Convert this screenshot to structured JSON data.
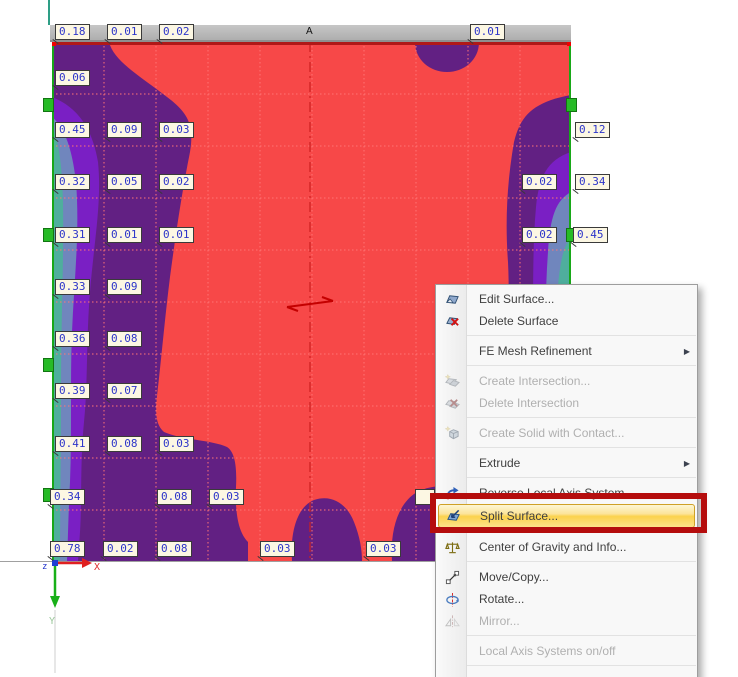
{
  "plot": {
    "section_label": "A",
    "axis": {
      "x": "X",
      "y": "Y",
      "z": "z"
    },
    "palette": {
      "field_red": "#f74848",
      "band_dark_purple": "#622083",
      "band_violet": "#7a1fc4",
      "band_slate_blue": "#7086bd",
      "band_teal": "#4fae9d",
      "grid_line": "#ff7575",
      "edge_line_green": "#18a818",
      "edge_line_red": "#b01818",
      "support_green": "#27bb27"
    },
    "value_labels": [
      {
        "v": "0.18",
        "x": 55,
        "y": 24
      },
      {
        "v": "0.01",
        "x": 107,
        "y": 24
      },
      {
        "v": "0.02",
        "x": 159,
        "y": 24
      },
      {
        "v": "0.01",
        "x": 470,
        "y": 24
      },
      {
        "v": "0.06",
        "x": 55,
        "y": 70
      },
      {
        "v": "0.45",
        "x": 55,
        "y": 122
      },
      {
        "v": "0.09",
        "x": 107,
        "y": 122
      },
      {
        "v": "0.03",
        "x": 159,
        "y": 122
      },
      {
        "v": "0.12",
        "x": 575,
        "y": 122
      },
      {
        "v": "0.32",
        "x": 55,
        "y": 174
      },
      {
        "v": "0.05",
        "x": 107,
        "y": 174
      },
      {
        "v": "0.02",
        "x": 159,
        "y": 174
      },
      {
        "v": "0.02",
        "x": 522,
        "y": 174
      },
      {
        "v": "0.34",
        "x": 575,
        "y": 174
      },
      {
        "v": "0.31",
        "x": 55,
        "y": 227
      },
      {
        "v": "0.01",
        "x": 107,
        "y": 227
      },
      {
        "v": "0.01",
        "x": 159,
        "y": 227
      },
      {
        "v": "0.02",
        "x": 522,
        "y": 227
      },
      {
        "v": "0.45",
        "x": 573,
        "y": 227
      },
      {
        "v": "0.33",
        "x": 55,
        "y": 279
      },
      {
        "v": "0.09",
        "x": 107,
        "y": 279
      },
      {
        "v": "0.36",
        "x": 55,
        "y": 331
      },
      {
        "v": "0.08",
        "x": 107,
        "y": 331
      },
      {
        "v": "0.39",
        "x": 55,
        "y": 383
      },
      {
        "v": "0.07",
        "x": 107,
        "y": 383
      },
      {
        "v": "0.41",
        "x": 55,
        "y": 436
      },
      {
        "v": "0.08",
        "x": 107,
        "y": 436
      },
      {
        "v": "0.03",
        "x": 159,
        "y": 436
      },
      {
        "v": "0.34",
        "x": 50,
        "y": 489
      },
      {
        "v": "0.08",
        "x": 157,
        "y": 489
      },
      {
        "v": "0.03",
        "x": 209,
        "y": 489
      },
      {
        "v": "",
        "x": 415,
        "y": 489,
        "partial": true
      },
      {
        "v": "0.78",
        "x": 50,
        "y": 541
      },
      {
        "v": "0.02",
        "x": 103,
        "y": 541
      },
      {
        "v": "0.08",
        "x": 157,
        "y": 541
      },
      {
        "v": "0.03",
        "x": 260,
        "y": 541
      },
      {
        "v": "0.03",
        "x": 366,
        "y": 541
      }
    ],
    "supports": [
      {
        "x": 43,
        "y": 98
      },
      {
        "x": 43,
        "y": 228
      },
      {
        "x": 43,
        "y": 358
      },
      {
        "x": 43,
        "y": 488
      },
      {
        "x": 566,
        "y": 98
      },
      {
        "x": 566,
        "y": 228
      }
    ]
  },
  "annotation": {
    "highlight_color": "#b50d0d"
  },
  "context_menu": {
    "items": [
      {
        "type": "item",
        "label": "Edit Surface...",
        "icon": "edit-surface-icon",
        "enabled": true
      },
      {
        "type": "item",
        "label": "Delete Surface",
        "icon": "delete-surface-icon",
        "enabled": true
      },
      {
        "type": "separator"
      },
      {
        "type": "item",
        "label": "FE Mesh Refinement",
        "enabled": true,
        "submenu": true
      },
      {
        "type": "separator"
      },
      {
        "type": "item",
        "label": "Create Intersection...",
        "icon": "create-intersection-icon",
        "enabled": false
      },
      {
        "type": "item",
        "label": "Delete Intersection",
        "icon": "delete-intersection-icon",
        "enabled": false
      },
      {
        "type": "separator"
      },
      {
        "type": "item",
        "label": "Create Solid with Contact...",
        "icon": "create-solid-icon",
        "enabled": false
      },
      {
        "type": "separator"
      },
      {
        "type": "item",
        "label": "Extrude",
        "enabled": true,
        "submenu": true
      },
      {
        "type": "separator"
      },
      {
        "type": "item",
        "label": "Reverse Local Axis System",
        "icon": "reverse-local-axis-icon",
        "enabled": true
      },
      {
        "type": "item",
        "label": "Split Surface...",
        "icon": "split-surface-icon",
        "enabled": true,
        "highlighted": true
      },
      {
        "type": "separator"
      },
      {
        "type": "item",
        "label": "Center of Gravity and Info...",
        "icon": "center-of-gravity-icon",
        "enabled": true
      },
      {
        "type": "separator"
      },
      {
        "type": "item",
        "label": "Move/Copy...",
        "icon": "move-copy-icon",
        "enabled": true
      },
      {
        "type": "item",
        "label": "Rotate...",
        "icon": "rotate-icon",
        "enabled": true
      },
      {
        "type": "item",
        "label": "Mirror...",
        "icon": "mirror-icon",
        "enabled": false
      },
      {
        "type": "separator"
      },
      {
        "type": "item",
        "label": "Local Axis Systems on/off",
        "enabled": false
      },
      {
        "type": "separator"
      }
    ]
  }
}
